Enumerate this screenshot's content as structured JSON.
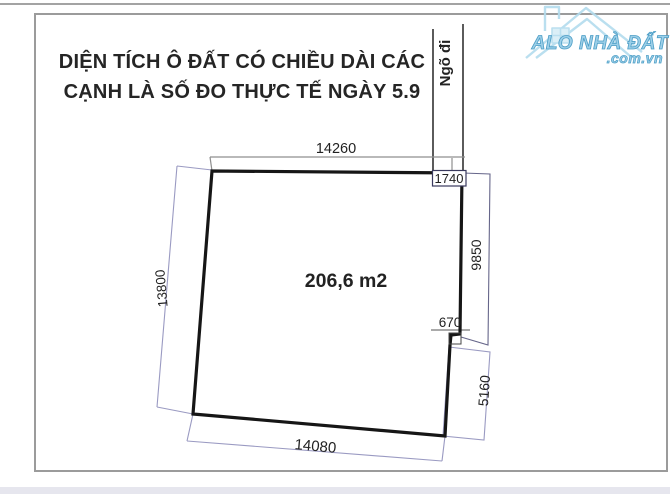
{
  "header": {
    "title_line1": "DIỆN TÍCH Ô ĐẤT CÓ CHIỀU DÀI CÁC",
    "title_line2": "CẠNH LÀ SỐ ĐO THỰC TẾ NGÀY 5.9"
  },
  "plot": {
    "area_label": "206,6 m2",
    "alley_label": "Ngõ đi",
    "dimensions": {
      "top": "14260",
      "alley_width": "1740",
      "right_upper": "9850",
      "step": "670",
      "right_lower": "5160",
      "bottom": "14080",
      "left": "13800"
    }
  },
  "watermark": {
    "brand": "ALO NHÀ ĐẤT",
    "domain": ".com.vn"
  },
  "colors": {
    "plot_outline": "#161616",
    "dimension_blue": "#9a9ac2",
    "dimension_navy": "#3a3a5e",
    "dimension_gray": "#8f8f8f",
    "frame_border": "#9b9b9b",
    "watermark_blue": "#9ccfe8",
    "footer_strip": "#e6e6ee"
  }
}
